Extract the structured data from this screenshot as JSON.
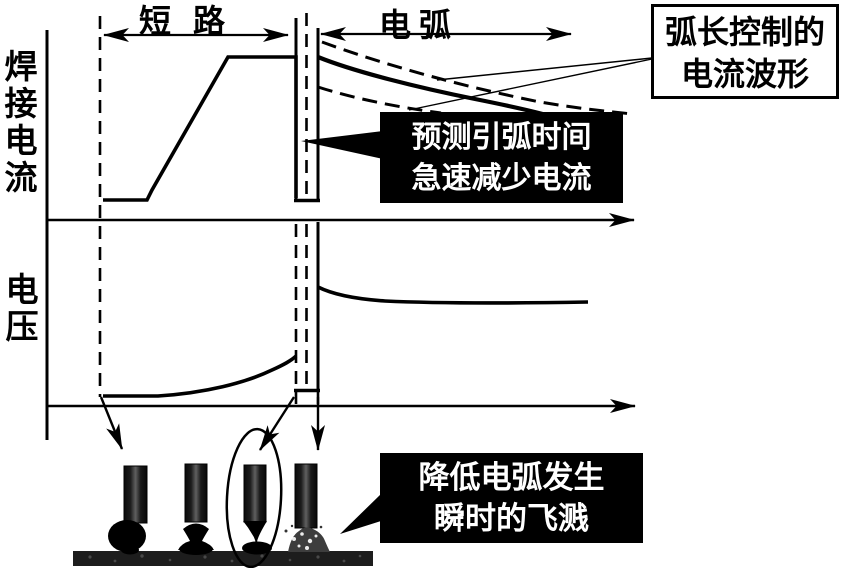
{
  "diagram": {
    "axes": {
      "current_label": "焊接电流",
      "voltage_label": "电压"
    },
    "phases": {
      "short_circuit": "短路",
      "arc": "电弧"
    },
    "callout_arc_length": {
      "line1": "弧长控制的",
      "line2": "电流波形"
    },
    "annotation_predict": {
      "line1": "预测引弧时间",
      "line2": "急速减少电流"
    },
    "annotation_spatter": {
      "line1": "降低电弧发生",
      "line2": "瞬时的飞溅"
    },
    "colors": {
      "ink": "#000000",
      "paper": "#ffffff",
      "annotation_bg": "#000000",
      "annotation_text": "#ffffff"
    }
  }
}
